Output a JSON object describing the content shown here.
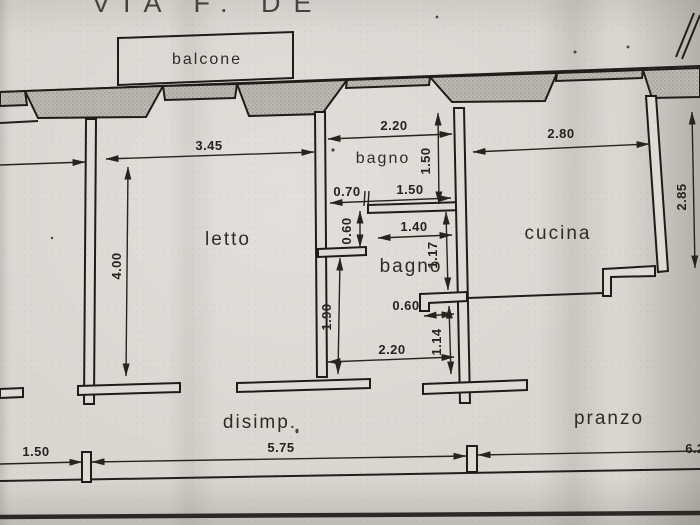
{
  "title": "VIA F. DE",
  "labels": {
    "balcone": "balcone",
    "letto": "letto",
    "bagno_top": "bagno",
    "bagno_bottom": "bagno",
    "cucina": "cucina",
    "disimp": "disimp.",
    "pranzo": "pranzo"
  },
  "dims": {
    "letto_width": "3.45",
    "letto_depth": "4.00",
    "bagno1_width": "2.20",
    "bagno1_depth": "1.50",
    "door_to_bagno1": "0.70",
    "bagno1_inner": "1.50",
    "niche_depth": "0.60",
    "bagno2_width": "1.40",
    "bagno2_depth_upper": "1.17",
    "bagno2_door": "0.60",
    "bagno2_depth_lower": "1.14",
    "antibagno_width": "2.20",
    "antibagno_depth": "1.90",
    "cucina_width": "2.80",
    "cucina_depth": "2.85",
    "facade_left": "1.50",
    "facade_middle": "5.75",
    "facade_right": "6.2"
  },
  "colors": {
    "paper": "#d9d7d2",
    "ink": "#211f1c",
    "pier_fill": "#bcbab3"
  }
}
